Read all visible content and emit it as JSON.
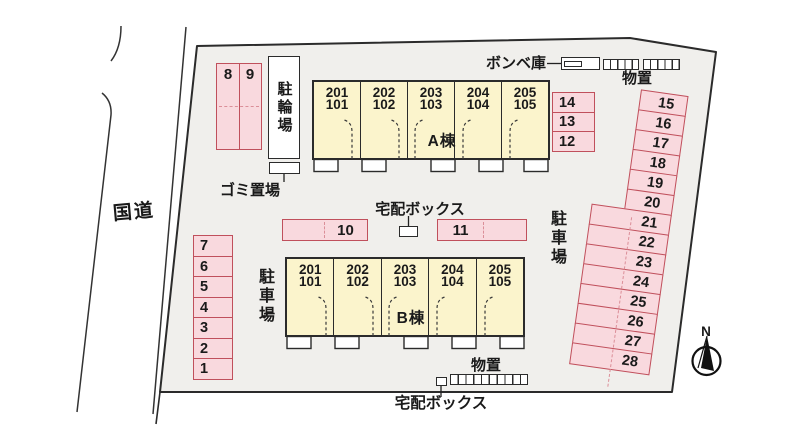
{
  "site": {
    "road_label": "国道",
    "compass_label": "N"
  },
  "facilities": {
    "bike_parking_label": "駐輪場",
    "garbage_label": "ゴミ置場",
    "gas_cylinder_label": "ボンベ庫",
    "storage_top_label": "物置",
    "storage_bottom_label": "物置",
    "delivery_box_mid_label": "宅配ボックス",
    "delivery_box_bottom_label": "宅配ボックス",
    "parking_label_left": "駐車場",
    "parking_label_right": "駐車場"
  },
  "buildings": {
    "a": {
      "name": "A棟",
      "units": [
        {
          "upper": "201",
          "lower": "101"
        },
        {
          "upper": "202",
          "lower": "102"
        },
        {
          "upper": "203",
          "lower": "103"
        },
        {
          "upper": "204",
          "lower": "104"
        },
        {
          "upper": "205",
          "lower": "105"
        }
      ]
    },
    "b": {
      "name": "B棟",
      "units": [
        {
          "upper": "201",
          "lower": "101"
        },
        {
          "upper": "202",
          "lower": "102"
        },
        {
          "upper": "203",
          "lower": "103"
        },
        {
          "upper": "204",
          "lower": "104"
        },
        {
          "upper": "205",
          "lower": "105"
        }
      ]
    }
  },
  "parking": {
    "pair89": [
      "8",
      "9"
    ],
    "left_column": [
      "7",
      "6",
      "5",
      "4",
      "3",
      "2",
      "1"
    ],
    "mid_left": "10",
    "mid_right": "11",
    "right_of_a": [
      "14",
      "13",
      "12"
    ],
    "right_column": [
      "15",
      "16",
      "17",
      "18",
      "19",
      "20",
      "21",
      "22",
      "23",
      "24",
      "25",
      "26",
      "27",
      "28"
    ]
  },
  "colors": {
    "pink": "#f9d9de",
    "red": "#c0505c",
    "red-dash": "#db8e98",
    "yellow": "#fbf4cc",
    "outline": "#2b2b2b",
    "ground": "#f0efec",
    "ink": "#1a1a1a"
  }
}
